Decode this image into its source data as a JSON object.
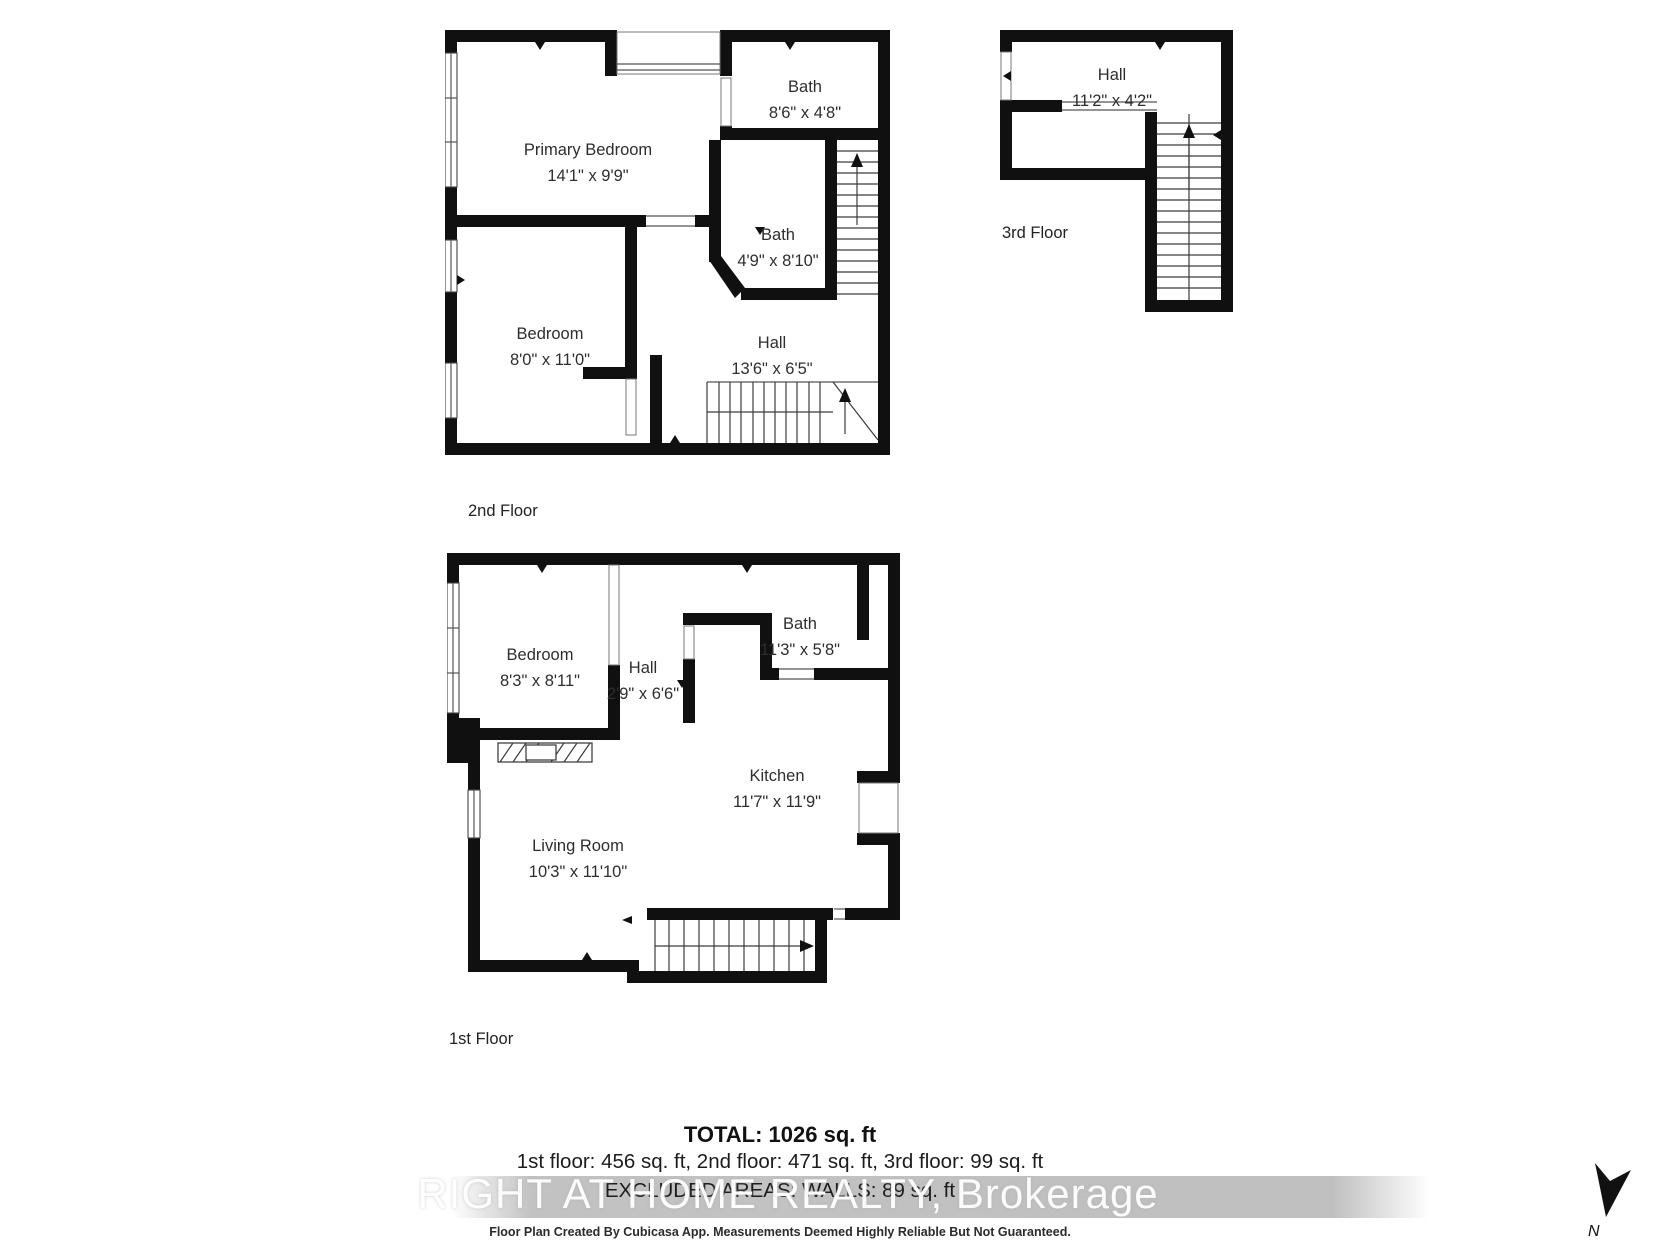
{
  "document": {
    "type": "floor-plan-sheet",
    "background_color": "#ffffff",
    "wall_color": "#101010",
    "text_color": "#2e2e2e",
    "watermark_color": "#c0c0c0"
  },
  "floors": [
    {
      "label": "2nd Floor",
      "rooms": [
        {
          "name": "Primary Bedroom",
          "dims": "14'1\" x 9'9\""
        },
        {
          "name": "Bath",
          "dims": "8'6\" x 4'8\""
        },
        {
          "name": "Bath",
          "dims": "4'9\" x 8'10\""
        },
        {
          "name": "Bedroom",
          "dims": "8'0\" x 11'0\""
        },
        {
          "name": "Hall",
          "dims": "13'6\" x 6'5\""
        }
      ]
    },
    {
      "label": "3rd Floor",
      "rooms": [
        {
          "name": "Hall",
          "dims": "11'2\" x 4'2\""
        }
      ]
    },
    {
      "label": "1st Floor",
      "rooms": [
        {
          "name": "Bedroom",
          "dims": "8'3\" x 8'11\""
        },
        {
          "name": "Hall",
          "dims": "2'9\" x 6'6\""
        },
        {
          "name": "Bath",
          "dims": "11'3\" x 5'8\""
        },
        {
          "name": "Kitchen",
          "dims": "11'7\" x 11'9\""
        },
        {
          "name": "Living Room",
          "dims": "10'3\" x 11'10\""
        }
      ]
    }
  ],
  "summary": {
    "total_line": "TOTAL: 1026 sq. ft",
    "floors_line": "1st floor: 456 sq. ft, 2nd floor: 471 sq. ft, 3rd floor: 99 sq. ft",
    "excluded_line": "EXCLUDED AREAS: WALLS: 89 sq. ft"
  },
  "watermark_text": "RIGHT AT HOME REALTY, Brokerage",
  "footer_text": "Floor Plan Created By Cubicasa App. Measurements Deemed Highly Reliable But Not Guaranteed.",
  "compass": {
    "label": "N"
  }
}
